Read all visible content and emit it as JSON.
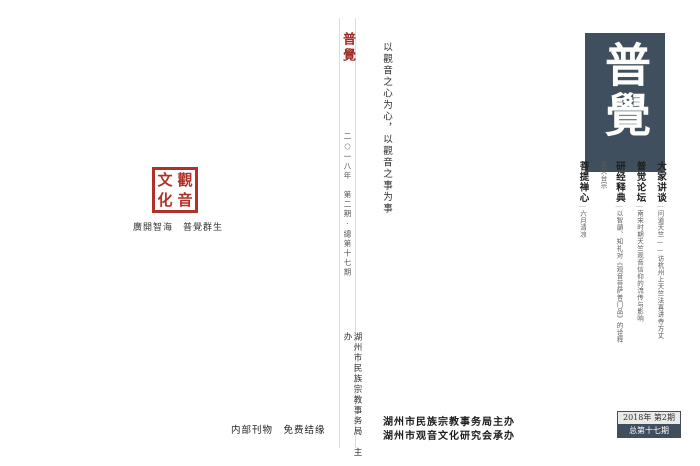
{
  "journal": {
    "title": "普覺",
    "slogan": "以觀音之心为心，以觀音之事为事"
  },
  "spine": {
    "logo": "普覺",
    "issue_line": "二○一八年　第二期·總第十七期",
    "publisher_line": "湖州市民族宗教事务局　主办"
  },
  "back_cover": {
    "seal_chars": [
      "觀",
      "音",
      "文",
      "化"
    ],
    "seal_caption": "廣開智海　普覺群生",
    "footer": "内部刊物　免费结缘"
  },
  "front_cover": {
    "masthead": "普覺",
    "divider": "｜",
    "articles": [
      {
        "section": "大家讲谈",
        "title": "问道天竺——访杭州上天竺法喜讲寺方丈"
      },
      {
        "section": "普觉论坛",
        "title": "南宋时期天竺观音信仰的流传与影响"
      },
      {
        "section": "研经释典",
        "title": "以智顗、知礼对《观音菩萨普门品》的诠释看天台宗"
      },
      {
        "section": "菩提禅心",
        "title": "六月清凉"
      },
      {
        "section": "禅艺品读",
        "title": "观音造像由男变女的文化阐释"
      },
      {
        "section": "西吴掌故",
        "title": "佛画之祖——曹不兴"
      },
      {
        "section": "圣迹巡礼",
        "title": "仁王正法永驻地　护国佑民显真常"
      }
    ],
    "issue_box": {
      "line1": "2018年 第2期",
      "line2": "总第十七期"
    },
    "organizers": [
      "湖州市民族宗教事务局主办",
      "湖州市观音文化研究会承办"
    ]
  },
  "colors": {
    "banner_slate": "#3f4f5d",
    "seal_red": "#b03127",
    "logo_red": "#a02c28"
  }
}
